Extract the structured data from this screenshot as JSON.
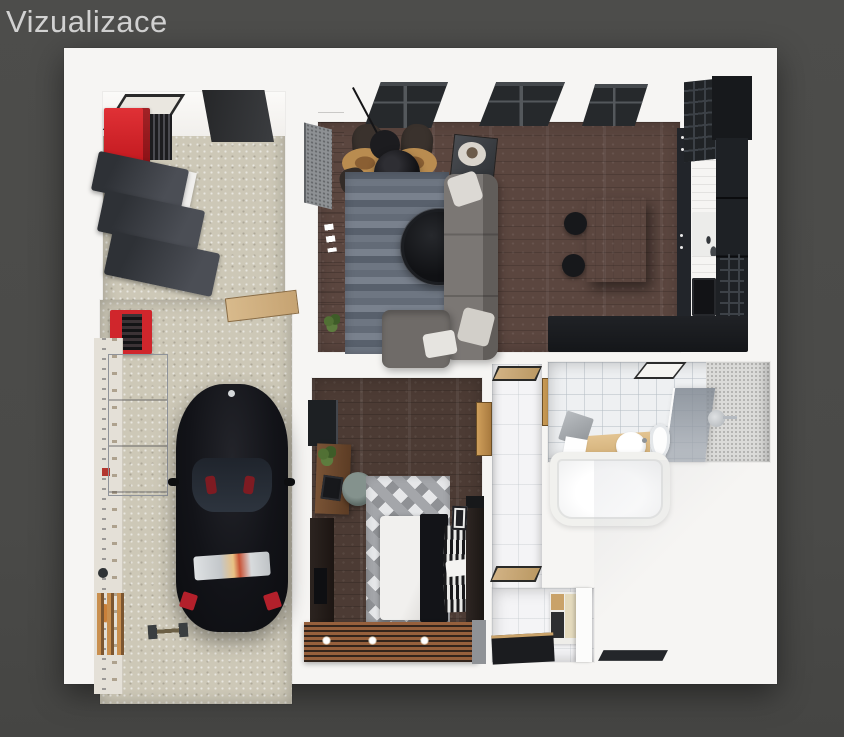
{
  "title": "Vizualizace",
  "palette": {
    "background": "#4b4b49",
    "title_text": "#d2d2d2",
    "canvas": "#f6f5f3",
    "accent_red": "#d0262c",
    "living_floor_wood": "#5b463f",
    "bedroom_floor_wood": "#4c3b34",
    "garage_floor_concrete": "#cdc8b7",
    "bathroom_tile": "#eef0f2",
    "rug_gray_blue": "#6a7380",
    "sofa_gray": "#6f6b68",
    "kitchen_wood": "#d9bd92",
    "dark_cabinetry": "#1d2023",
    "car_black": "#131417",
    "balcony_slat_wood": "#96603c"
  }
}
